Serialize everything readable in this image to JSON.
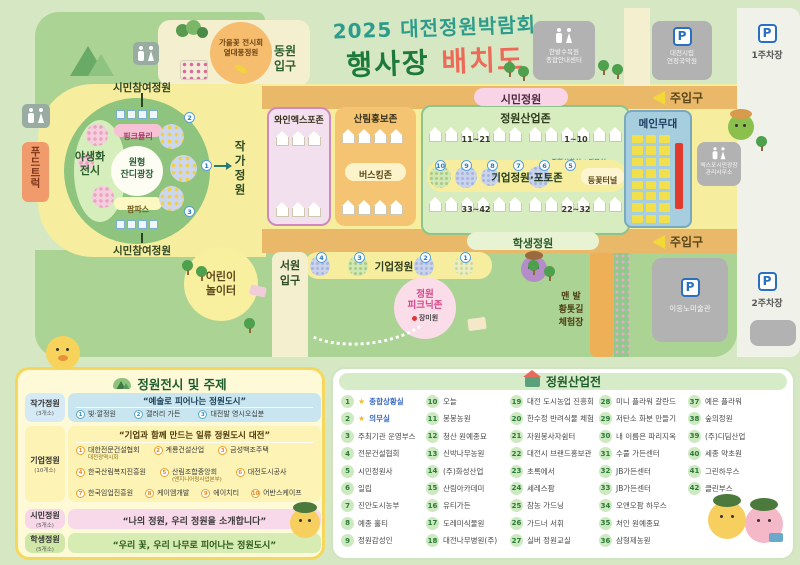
{
  "title": {
    "line1": "2025 대전정원박람회",
    "line2_part1": "행사장",
    "line2_part2": "배치도"
  },
  "top": {
    "autumn_badge": "가을꽃 전시회\n열대풍정원",
    "east_gate": "동원\n입구",
    "info_center": "한밭수목원\n종합안내센터",
    "music_center": "대전시립\n연정국악원",
    "parking1": "1주차장"
  },
  "map": {
    "food_truck": "푸드트럭",
    "citizen_participation_top": "시민참여정원",
    "citizen_participation_bottom": "시민참여정원",
    "pink_muhly": "핑크뮬리",
    "circular_lawn": "원형\n잔디광장",
    "pampas": "팜파스",
    "wildflower": "야생화\n전시",
    "artist_garden": "작가정원",
    "wine_expo_zone": "와인엑스포존",
    "forest_promo_zone": "산림홍보존",
    "busking_zone": "버스킹존",
    "garden_industry_zone": "정원산업존",
    "tent_labels": [
      "11~21",
      "1~10",
      "33~42",
      "22~32"
    ],
    "status_room": "종합상황실 / 의무실",
    "corp_photo_zone": "기업정원·포토존",
    "wisteria_tunnel": "등꽃터널",
    "badge_numbers_industry": [
      "10",
      "9",
      "8",
      "7",
      "6",
      "5"
    ],
    "badge_numbers_circle": [
      "2",
      "1",
      "3"
    ],
    "badge_numbers_corp": [
      "4",
      "3",
      "2",
      "1"
    ],
    "main_stage": "메인무대",
    "citizen_garden": "시민정원",
    "main_gate_top": "주입구",
    "main_gate_bottom": "주입구",
    "expo_office": "엑스포시민광장\n관리사무소",
    "student_garden": "학생정원",
    "corp_garden_band": "기업정원",
    "seowon_gate": "서원\n입구",
    "children_playground": "어린이\n놀이터",
    "picnic_zone": "정원\n피크닉존",
    "rose_garden": "장미원",
    "barefoot_path": "맨 발\n황톳길\n체험장",
    "museum": "이응노미술관",
    "parking2": "2주차장"
  },
  "left_panel": {
    "title": "정원전시 및 주제",
    "sections": [
      {
        "label": "작가정원",
        "count": "(3개소)",
        "quote": "“예술로 피어나는 정원도시”",
        "items": [
          {
            "no": "1",
            "name": "빛·깔정원"
          },
          {
            "no": "2",
            "name": "갤러리 가든"
          },
          {
            "no": "3",
            "name": "대전발 영시오십분"
          }
        ]
      },
      {
        "label": "기업정원",
        "count": "(10개소)",
        "quote": "“기업과 함께 만드는 일류 정원도시 대전”",
        "items": [
          {
            "no": "1",
            "name": "대한전문건설협회",
            "sub": "대전광역시회"
          },
          {
            "no": "2",
            "name": "계룡건설산업"
          },
          {
            "no": "3",
            "name": "금성백조주택"
          },
          {
            "no": "4",
            "name": "한국산림복지진흥원"
          },
          {
            "no": "5",
            "name": "산림조합중앙회",
            "sub": "(엔지니어링사업본부)"
          },
          {
            "no": "6",
            "name": "대전도시공사"
          },
          {
            "no": "7",
            "name": "한국임업진흥원"
          },
          {
            "no": "8",
            "name": "케이엠개발"
          },
          {
            "no": "9",
            "name": "에이치티"
          },
          {
            "no": "10",
            "name": "어반스케이프"
          }
        ]
      },
      {
        "label": "시민정원",
        "count": "(5개소)",
        "quote": "“나의 정원, 우리 정원을 소개합니다”",
        "items": []
      },
      {
        "label": "학생정원",
        "count": "(5개소)",
        "quote": "“우리 꽃, 우리 나무로 피어나는 정원도시”",
        "items": []
      }
    ]
  },
  "right_panel": {
    "title": "정원산업전",
    "booths": [
      {
        "no": "1",
        "name": "종합상황실",
        "star": true
      },
      {
        "no": "2",
        "name": "의무실",
        "star": true
      },
      {
        "no": "3",
        "name": "주최기관 운영부스"
      },
      {
        "no": "4",
        "name": "전문건설협회"
      },
      {
        "no": "5",
        "name": "시민정원사"
      },
      {
        "no": "6",
        "name": "일립"
      },
      {
        "no": "7",
        "name": "진안도시농부"
      },
      {
        "no": "8",
        "name": "예종 홀티"
      },
      {
        "no": "9",
        "name": "정원감성인"
      },
      {
        "no": "10",
        "name": "오늘"
      },
      {
        "no": "11",
        "name": "봉봉농원"
      },
      {
        "no": "12",
        "name": "청산 원예종묘"
      },
      {
        "no": "13",
        "name": "신박나무농원"
      },
      {
        "no": "14",
        "name": "(주)화성산업"
      },
      {
        "no": "15",
        "name": "산림아카데미"
      },
      {
        "no": "16",
        "name": "유티가든"
      },
      {
        "no": "17",
        "name": "도레미식물원"
      },
      {
        "no": "18",
        "name": "대전나무병원(주)"
      },
      {
        "no": "19",
        "name": "대전 도시농업 진흥회"
      },
      {
        "no": "20",
        "name": "한수정 반려식물 체험"
      },
      {
        "no": "21",
        "name": "자원봉사자쉼터"
      },
      {
        "no": "22",
        "name": "대전시 브랜드홍보관"
      },
      {
        "no": "23",
        "name": "초록에서"
      },
      {
        "no": "24",
        "name": "세레스팜"
      },
      {
        "no": "25",
        "name": "참농 가드닝"
      },
      {
        "no": "26",
        "name": "가드너 서휘"
      },
      {
        "no": "27",
        "name": "실버 정원교실"
      },
      {
        "no": "28",
        "name": "미니 플라워 갈란드"
      },
      {
        "no": "29",
        "name": "저탄소 화분 만들기"
      },
      {
        "no": "30",
        "name": "내 이름은 파리지옥"
      },
      {
        "no": "31",
        "name": "수풀 가든센터"
      },
      {
        "no": "32",
        "name": "JB가든센터"
      },
      {
        "no": "33",
        "name": "JB가든센터"
      },
      {
        "no": "34",
        "name": "오앤오팜 하우스"
      },
      {
        "no": "35",
        "name": "처인 원예종묘"
      },
      {
        "no": "36",
        "name": "삼형제농원"
      },
      {
        "no": "37",
        "name": "예은 플라워"
      },
      {
        "no": "38",
        "name": "숲의정원"
      },
      {
        "no": "39",
        "name": "(주)디딤산업"
      },
      {
        "no": "40",
        "name": "세종 약초원"
      },
      {
        "no": "41",
        "name": "그린하우스"
      },
      {
        "no": "42",
        "name": "클린부스"
      }
    ]
  },
  "colors": {
    "map_green": "#abd394",
    "path_cream": "#f3efcf",
    "zone_yellow": "#f6ee9e",
    "road_orange": "#e9b869",
    "wine_pink": "#f3e0ee",
    "forest_orange": "#f4c473",
    "industry_green": "#d8edbf",
    "stage_blue": "#a6cede",
    "stage_red": "#e03a2c",
    "title_teal": "#2d9c8c",
    "title_green": "#1e7a3a",
    "title_red": "#ee6a58",
    "panel_cream": "#fefad8",
    "panel_border": "#f5d75e",
    "booth_circle": "#cde9c0"
  }
}
